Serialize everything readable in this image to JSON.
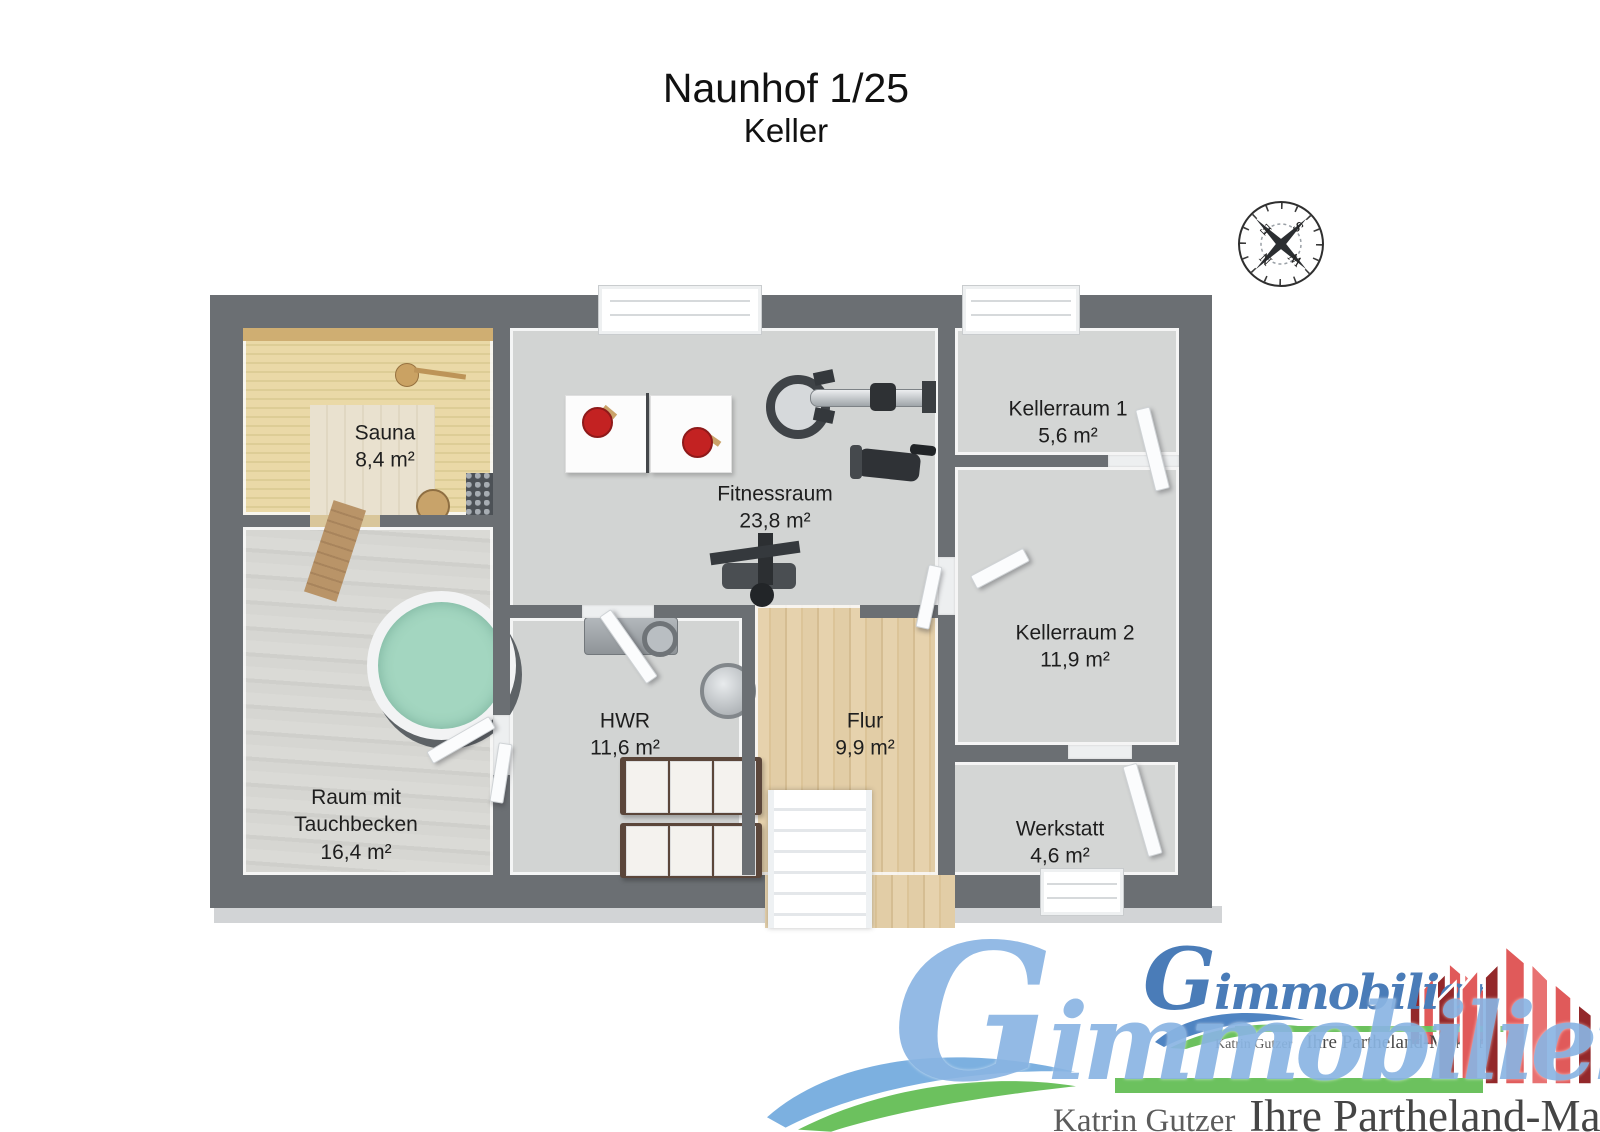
{
  "title": {
    "line1": "Naunhof 1/25",
    "line2": "Keller"
  },
  "compass": {
    "n": "N",
    "e": "E",
    "s": "S",
    "w": "W"
  },
  "rooms": [
    {
      "name": "Sauna",
      "area": "8,4 m²"
    },
    {
      "name": "Fitnessraum",
      "area": "23,8 m²"
    },
    {
      "name": "Kellerraum 1",
      "area": "5,6 m²"
    },
    {
      "name": "Kellerraum 2",
      "area": "11,9 m²"
    },
    {
      "name": "Raum mit Tauchbecken",
      "area": "16,4 m²"
    },
    {
      "name": "HWR",
      "area": "11,6 m²"
    },
    {
      "name": "Flur",
      "area": "9,9 m²"
    },
    {
      "name": "Werkstatt",
      "area": "4,6 m²"
    }
  ],
  "logo": {
    "brand_initial": "G",
    "brand_rest": "immobilien",
    "owner": "Katrin Gutzer",
    "tagline": "Ihre Partheland-Maklerin",
    "colors": {
      "light_blue": "#8ab5e3",
      "dark_blue": "#4a7cb8",
      "green": "#6cc15e",
      "red": "#e05a5a",
      "dark_red": "#93282a"
    }
  },
  "plan_colors": {
    "wall": "#6b6f73",
    "floor": "#d3d5d4",
    "sauna_wood": "#ead9a7",
    "hall_wood": "#e2cda6",
    "pool": "#a3d6c0"
  }
}
